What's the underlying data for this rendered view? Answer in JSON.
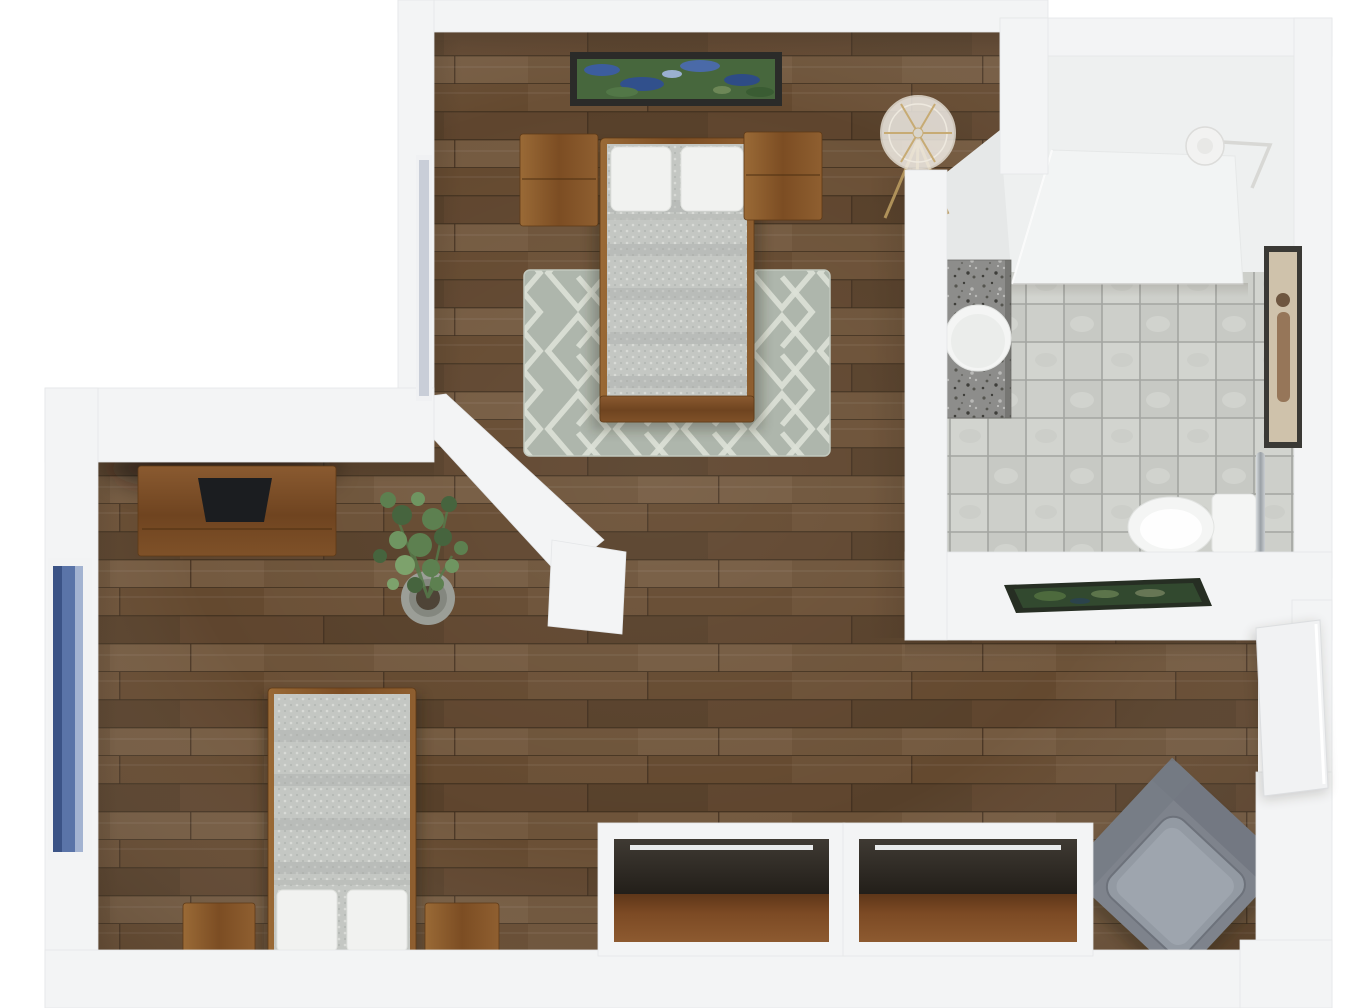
{
  "scene": {
    "label": "3D rendered top-down floor plan of a one-bedroom apartment",
    "type": "floor-plan-3d-render",
    "rooms": [
      {
        "id": "bedroom",
        "items": [
          "double-bed",
          "pillow",
          "pillow",
          "nightstand-left",
          "nightstand-right",
          "trellis-area-rug",
          "waterlilies-wall-art",
          "tripod-floor-lamp",
          "west-wall-window"
        ]
      },
      {
        "id": "bathroom",
        "items": [
          "shower-tub-platform",
          "granite-vanity",
          "round-sink",
          "toilet",
          "toilet-tank",
          "towel-ring",
          "towel-rod",
          "chrome-grab-bar",
          "tile-floor",
          "portrait-wall-art",
          "green-wall-art"
        ]
      },
      {
        "id": "living-room",
        "items": [
          "tv-console",
          "flat-tv",
          "potted-plant",
          "daybed",
          "pillow",
          "pillow",
          "stool-left",
          "stool-right",
          "tall-blue-window"
        ]
      },
      {
        "id": "hallway",
        "items": [
          "grey-armchair",
          "open-entry-door",
          "window-recess-left",
          "window-recess-right",
          "wood-window-sill",
          "curtain-rod"
        ]
      }
    ]
  },
  "palette": {
    "background": "#ffffff",
    "wall": "#f3f4f5",
    "wall_bright": "#eef0f0",
    "wall_shadow": "#e1e3e5",
    "wood": "#6b5036",
    "wood_dark": "#5f452e",
    "wood_light": "#745a40",
    "plank_seam": "#41301f",
    "furn_wood": "#8a5a2e",
    "furn_wood_dark": "#6b421f",
    "rug": "#aeb6ac",
    "rug_line": "#dde2d8",
    "blanket": "#c4c7c3",
    "blanket_dot": "#d9dbd7",
    "pillow": "#f1f2f0",
    "tile": "#cdcfca",
    "grout": "#a3a5a1",
    "granite": "#8d8d8b",
    "fixture_white": "#f4f5f4",
    "chrome": "#b9bec3",
    "tv": "#1b1d20",
    "plant": "#5d8050",
    "plant_dark": "#46643e",
    "pot": "#9b9e97",
    "glass_blue": "#5a74a8",
    "glass_blue_dark": "#3b5386",
    "frame_dark": "#2b2b29",
    "canvas_beige": "#cfc2ab",
    "art_green": "#32492f",
    "lamp_gold": "#b99a5f",
    "lamp_shade": "#f5f2ec",
    "chair": "#7e838c",
    "chair_light": "#939aa3",
    "recess": "#2b2824",
    "sill": "#7c4a24",
    "door": "#f1f2f3"
  }
}
